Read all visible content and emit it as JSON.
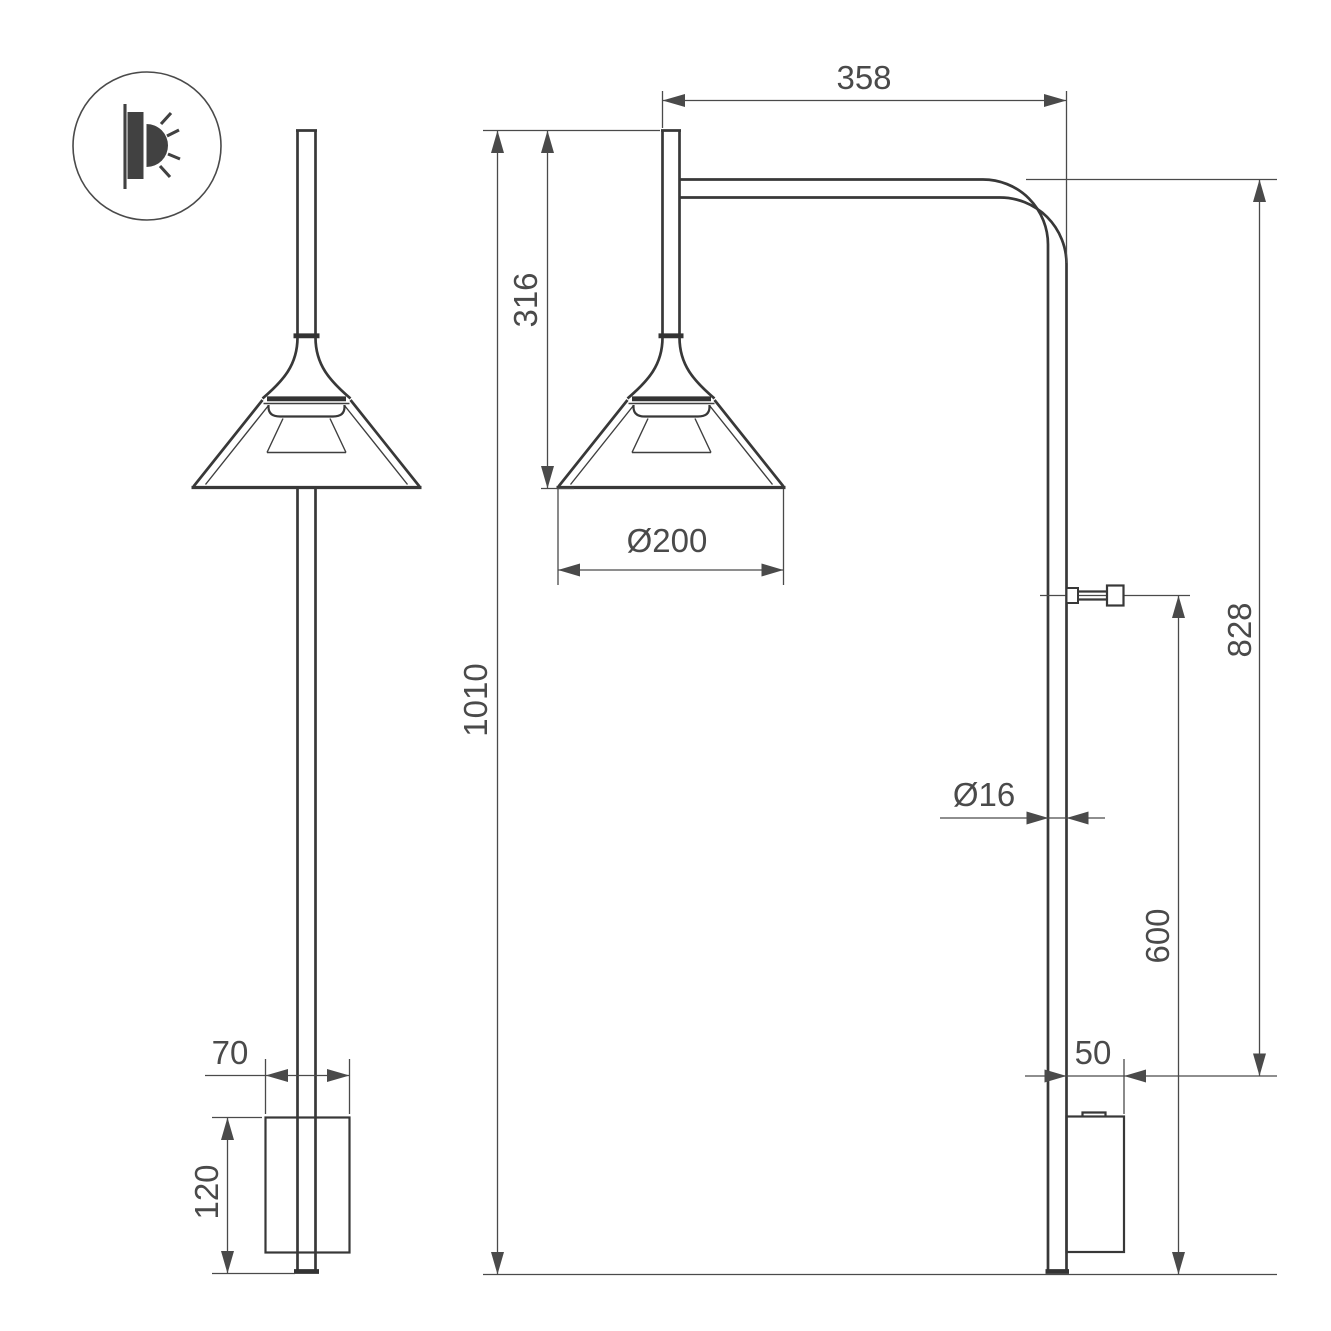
{
  "colors": {
    "background": "#ffffff",
    "object_line": "#383838",
    "dimension_line": "#4a4a4a",
    "text": "#4a4a4a"
  },
  "icon": {
    "name": "wall-light-emission-icon"
  },
  "dims": {
    "arm": "358",
    "head": "316",
    "shade_dia": "Ø200",
    "total": "1010",
    "upper_right": "828",
    "tube_dia": "Ø16",
    "lower_right": "600",
    "mount_w": "70",
    "mount_h": "120",
    "mount_d": "50"
  }
}
